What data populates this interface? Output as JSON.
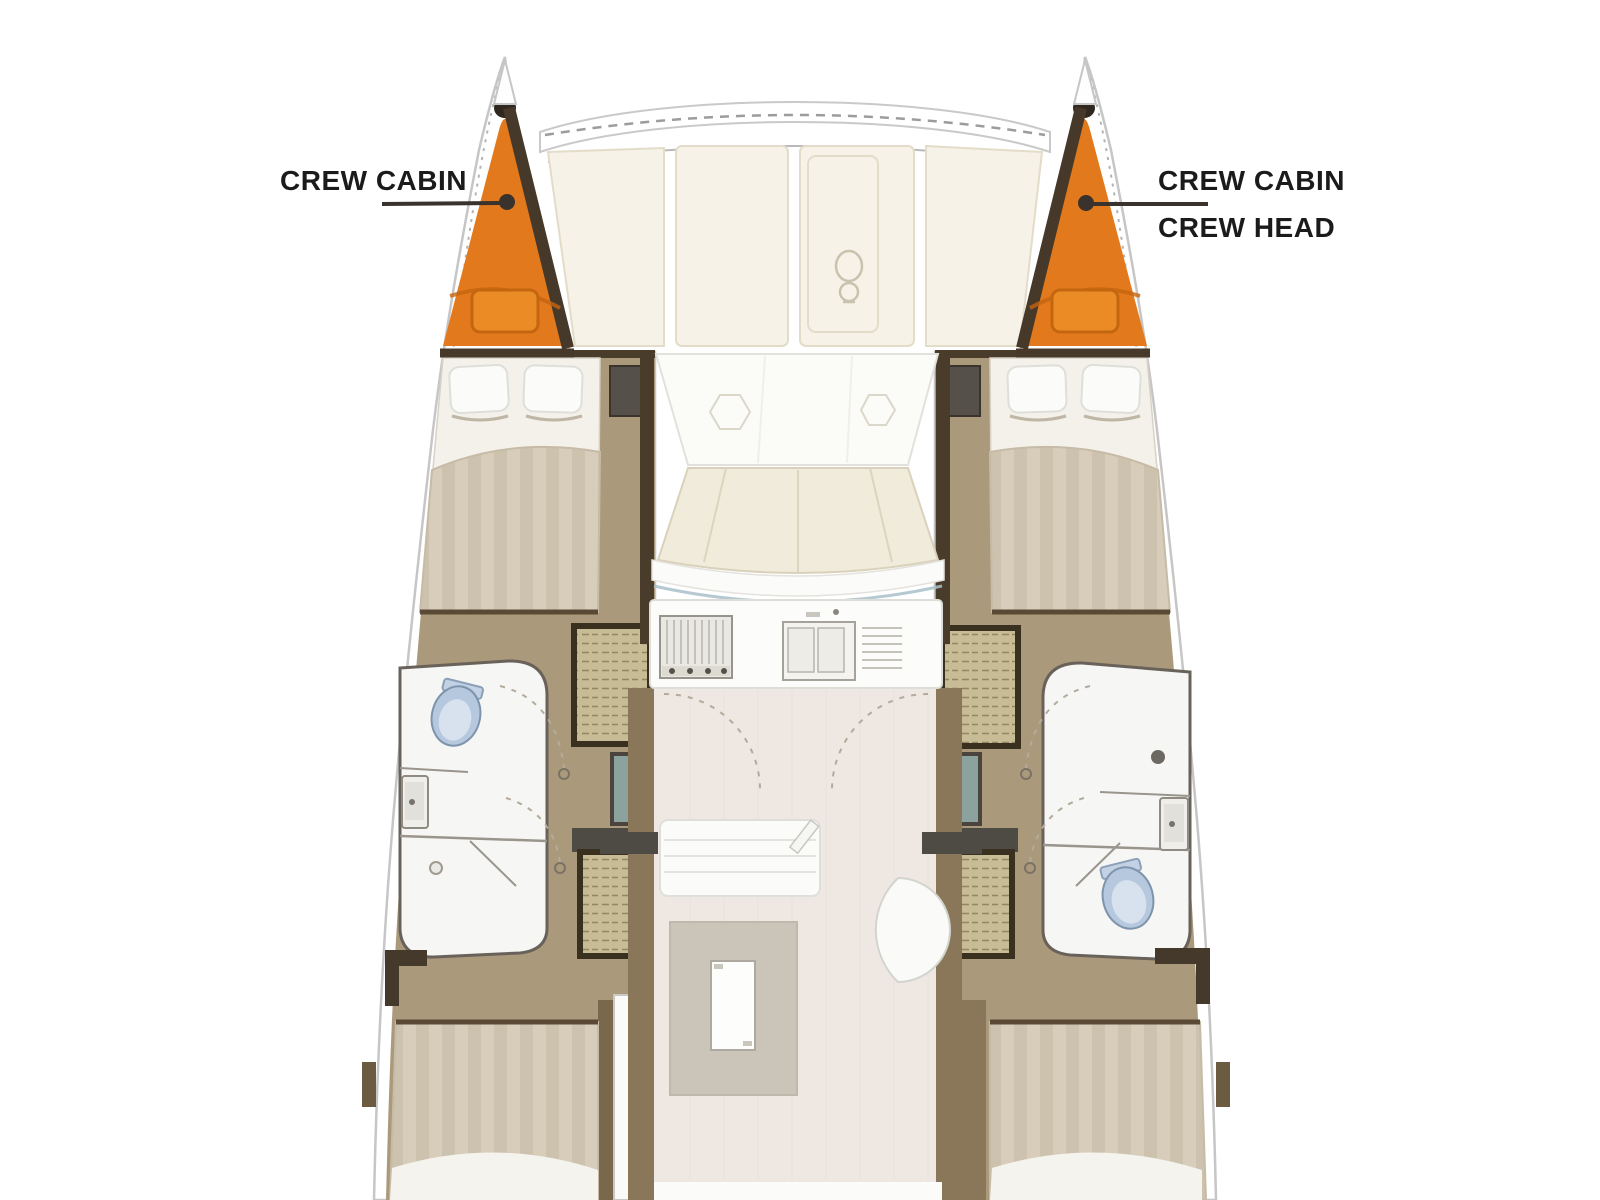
{
  "annotations": {
    "port": {
      "label": "CREW CABIN"
    },
    "starboard": {
      "label_line1": "CREW CABIN",
      "label_line2": "CREW HEAD"
    }
  },
  "colors": {
    "crew_cabin_fill": "#E27A1D",
    "crew_cabin_pillow": "#EA8B26",
    "label_text": "#1B1B1B",
    "leader_line": "#3A322C",
    "hull_stroke": "#C6C6C6",
    "deck_panel": "#F6F2E7",
    "cushion": "#F1EBDB",
    "wood_floor": "#AB997B",
    "dark_trim": "#4A3C2B",
    "teal_cabinet": "#8CA29E",
    "toilet": "#B5C8DE",
    "saloon_floor": "#EFE8E2",
    "table": "#CBC4B8"
  }
}
